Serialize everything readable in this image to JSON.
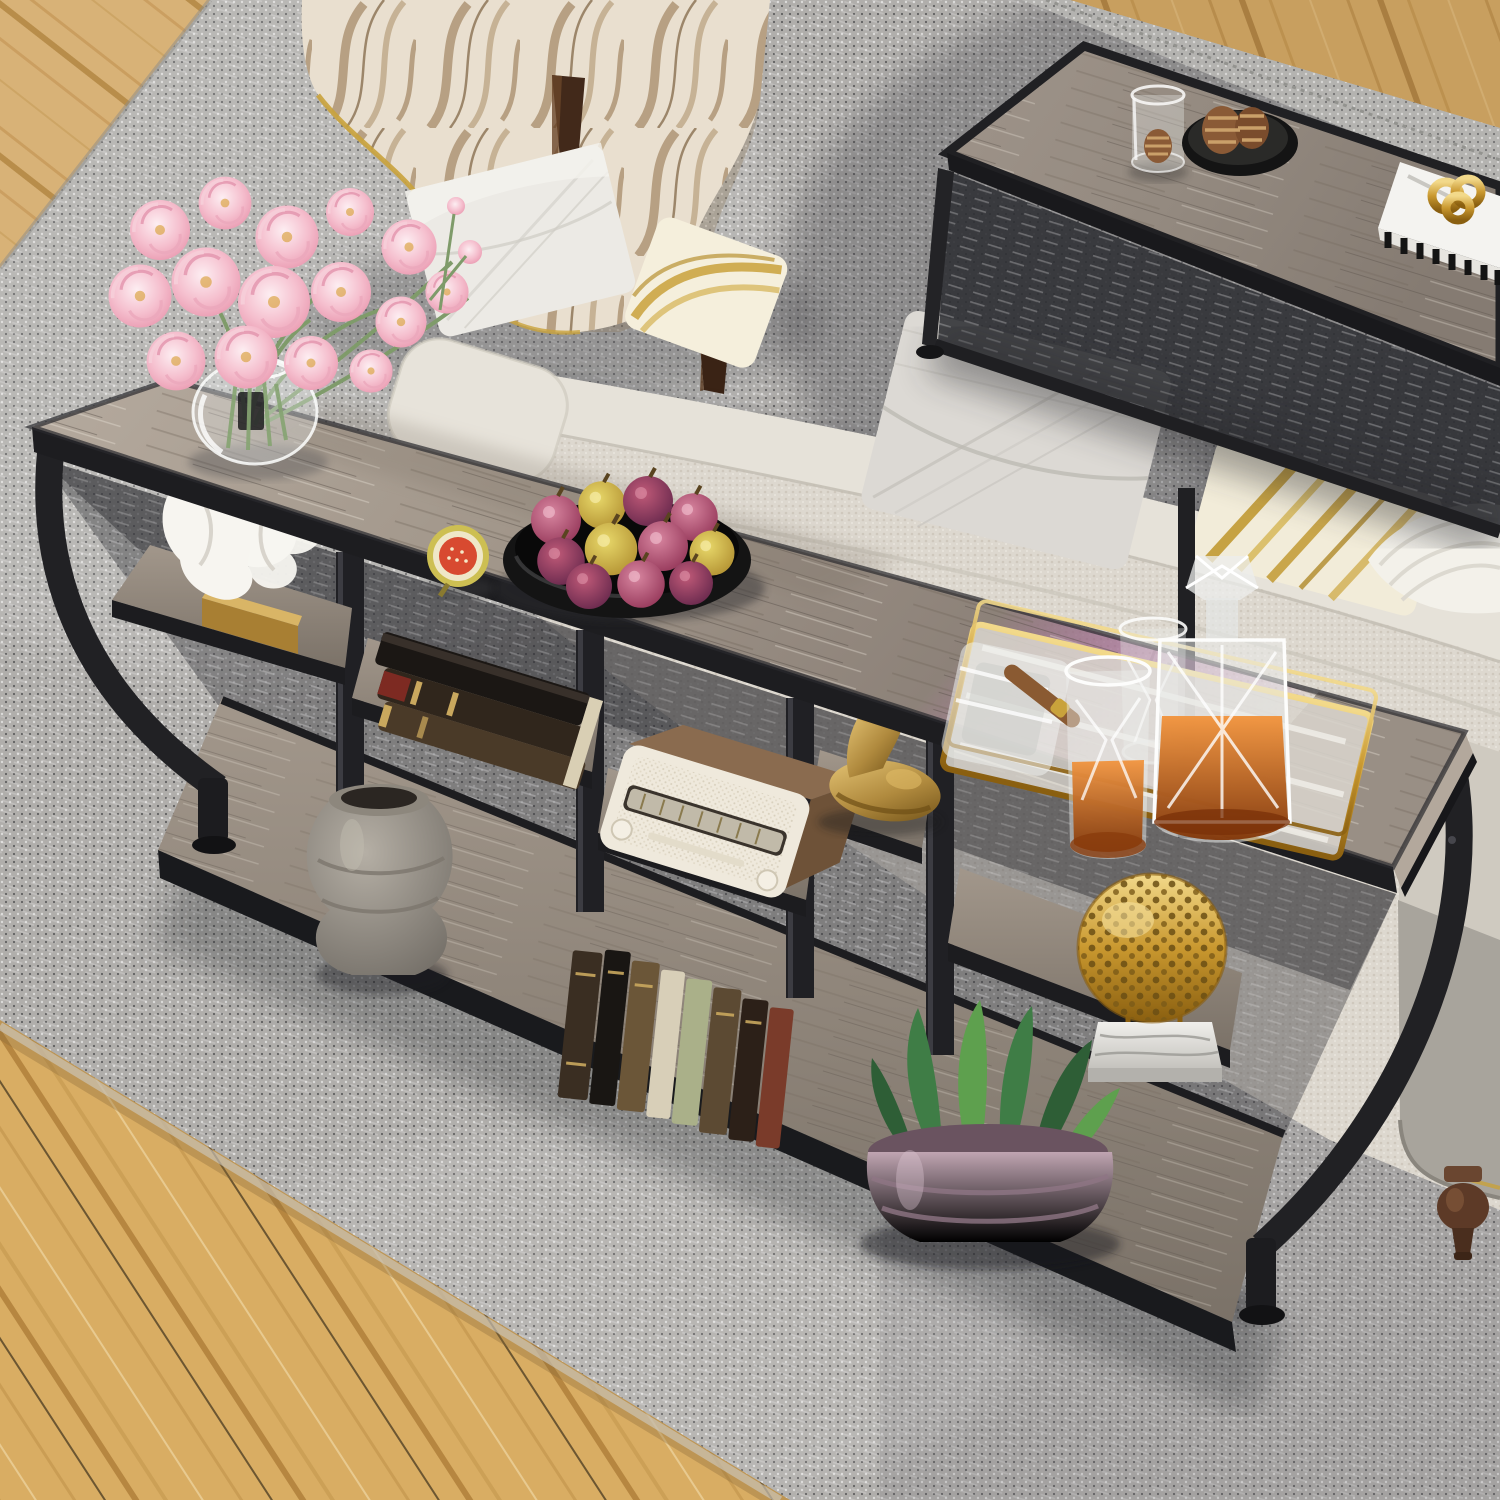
{
  "meta": {
    "type": "product-lifestyle-photo",
    "description": "Overhead view of a living room: an industrial narrow console sofa table with curved black metal frame and staggered rustic gray wood shelves placed behind a beige fabric sofa, styled with decor, on a gray woven rug with light oak flooring at the corners."
  },
  "palette": {
    "rug_light": "#c3c1be",
    "rug_mid": "#aoaoa4",
    "rug_dark": "#4c4e55",
    "floor_oak": "#d2a763",
    "table_wood": "#a79c90",
    "shelf_wood": "#948a7f",
    "metal_black": "#1f1f22",
    "sofa_beige": "#ddd8cf",
    "chair_cream": "#e9dfcf",
    "gold": "#c9982f",
    "brass": "#9a7a30",
    "flower_pink": "#f2b9c8",
    "leaf_green": "#4f8f4f",
    "pot_mauve": "#ad92a0",
    "whiskey_amber": "#c96a1e"
  },
  "objects": {
    "rug": {
      "label": "gray woven area rug",
      "color": "#b0aeab"
    },
    "floor": {
      "label": "light oak wood floor",
      "color": "#d2a763"
    },
    "armchair": {
      "label": "cream patterned accent armchair with dark wood legs",
      "color": "#e9dfcf"
    },
    "pillow_white": {
      "label": "white knife-edge pillow on armchair",
      "color": "#eceae5"
    },
    "sofa": {
      "label": "beige fabric sofa seen from behind",
      "color": "#ddd8cf"
    },
    "pillow_gold_leaf": {
      "label": "gold leaf-print pillow",
      "color": "#f5efdc"
    },
    "pillow_gray": {
      "label": "gray knife-edge pillow",
      "color": "#dcd9d4"
    },
    "pillow_gold_stripe": {
      "label": "gold striped pillow",
      "color": "#f2ecd9"
    },
    "throw_knit": {
      "label": "chunky white knit throw",
      "color": "#f3f1ea"
    },
    "sofa_leg": {
      "label": "turned espresso sofa leg",
      "color": "#5d3a27"
    },
    "coffee_table": {
      "label": "black metal coffee table with gray wood top",
      "color": "#a79c8f"
    },
    "glass_jar": {
      "label": "glass jar with small pinecone",
      "color": "#e8e8e6"
    },
    "pinecone_plate": {
      "label": "black plate with pinecones",
      "color": "#1a1a1a"
    },
    "white_books": {
      "label": "white books with gold knot sculpture",
      "color": "#f4f3f0"
    },
    "console_table": {
      "label": "industrial console sofa table, curved black metal frame, staggered rustic gray shelves",
      "color": "#a79c90"
    },
    "flower_vase": {
      "label": "pink peonies in round glass vase",
      "color": "#f2b9c8"
    },
    "fig_half": {
      "label": "halved fig",
      "color": "#d84a30"
    },
    "fig_bowl": {
      "label": "black bowl of fresh figs",
      "color": "#8e3c5c"
    },
    "bar_tray": {
      "label": "gold mirrored tray with crystal decanter, whiskey glasses, ashtray and cigar",
      "color": "#c9982f"
    },
    "coral_sculpture": {
      "label": "white coral sculpture on gold base",
      "color": "#f7f5f0"
    },
    "book_stack": {
      "label": "stack of antique leather books",
      "color": "#30261c"
    },
    "ceramic_urn": {
      "label": "weathered gray ceramic urn",
      "color": "#a39d93"
    },
    "vintage_radio": {
      "label": "cream vintage radio with wood top",
      "color": "#efe9dc"
    },
    "standing_books": {
      "label": "row of antique books",
      "color": "#5c4a33"
    },
    "deer_figurine": {
      "label": "brass resting deer figurine",
      "color": "#b08a3e"
    },
    "gold_sphere": {
      "label": "gold openwork sphere on marble base",
      "color": "#c9982f"
    },
    "potted_plant": {
      "label": "green succulent in mauve ribbed pot",
      "color": "#4f8f4f"
    }
  }
}
